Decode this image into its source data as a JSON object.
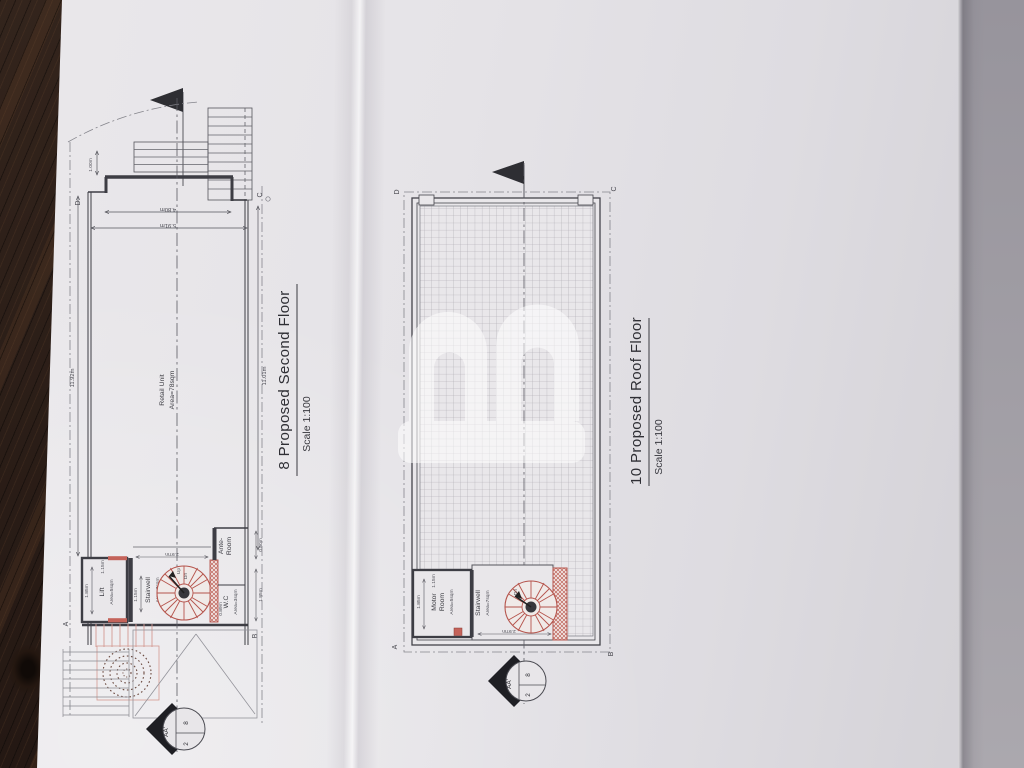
{
  "watermark": {
    "letter": "B"
  },
  "plan_second": {
    "title": "8 Proposed Second Floor",
    "scale": "Scale 1:100",
    "retail_name": "Retail Unit",
    "retail_area": "Area=78sqm",
    "lift_name": "Lift",
    "lift_area": "Area=5sqm",
    "stair_name": "Stairwell",
    "stair_area": "Area=7sqm",
    "wc_name": "W.C",
    "wc_area": "Area=3sqm",
    "ante_line1": "Ante-",
    "ante_line2": "Room",
    "up": "Up",
    "dn": "Dn",
    "dim_left": "11.92m",
    "dim_right": "11.01m",
    "dim_recess": "1.00m",
    "dim_bay": "4.80m",
    "dim_width": "5.91m",
    "dim_lift_w": "1.85m",
    "dim_lift_d": "1.15m",
    "dim_stair_w": "1.15m",
    "dim_stair_l": "2.97m",
    "dim_wc": "0.89m",
    "dim_ante": "0.80m",
    "dim_right_lower": "1.85m",
    "corner_d": "D",
    "corner_c": "C",
    "corner_a": "A",
    "corner_b": "B",
    "marker_label": "AA'",
    "marker_num": "2",
    "marker_sheet": "8"
  },
  "plan_roof": {
    "title": "10 Proposed Roof Floor",
    "scale": "Scale 1:100",
    "motor_line1": "Motor",
    "motor_line2": "Room",
    "motor_area": "Area=5sqm",
    "stair_name": "Stairwell",
    "stair_area": "Area=7sqm",
    "dn": "Dn",
    "dim_motor_w": "1.85m",
    "dim_motor_d": "1.15m",
    "dim_stair_l": "2.97m",
    "corner_d": "D",
    "corner_c": "C",
    "corner_a": "A",
    "corner_b": "B",
    "marker_label": "AA'",
    "marker_num": "2",
    "marker_sheet": "8"
  }
}
